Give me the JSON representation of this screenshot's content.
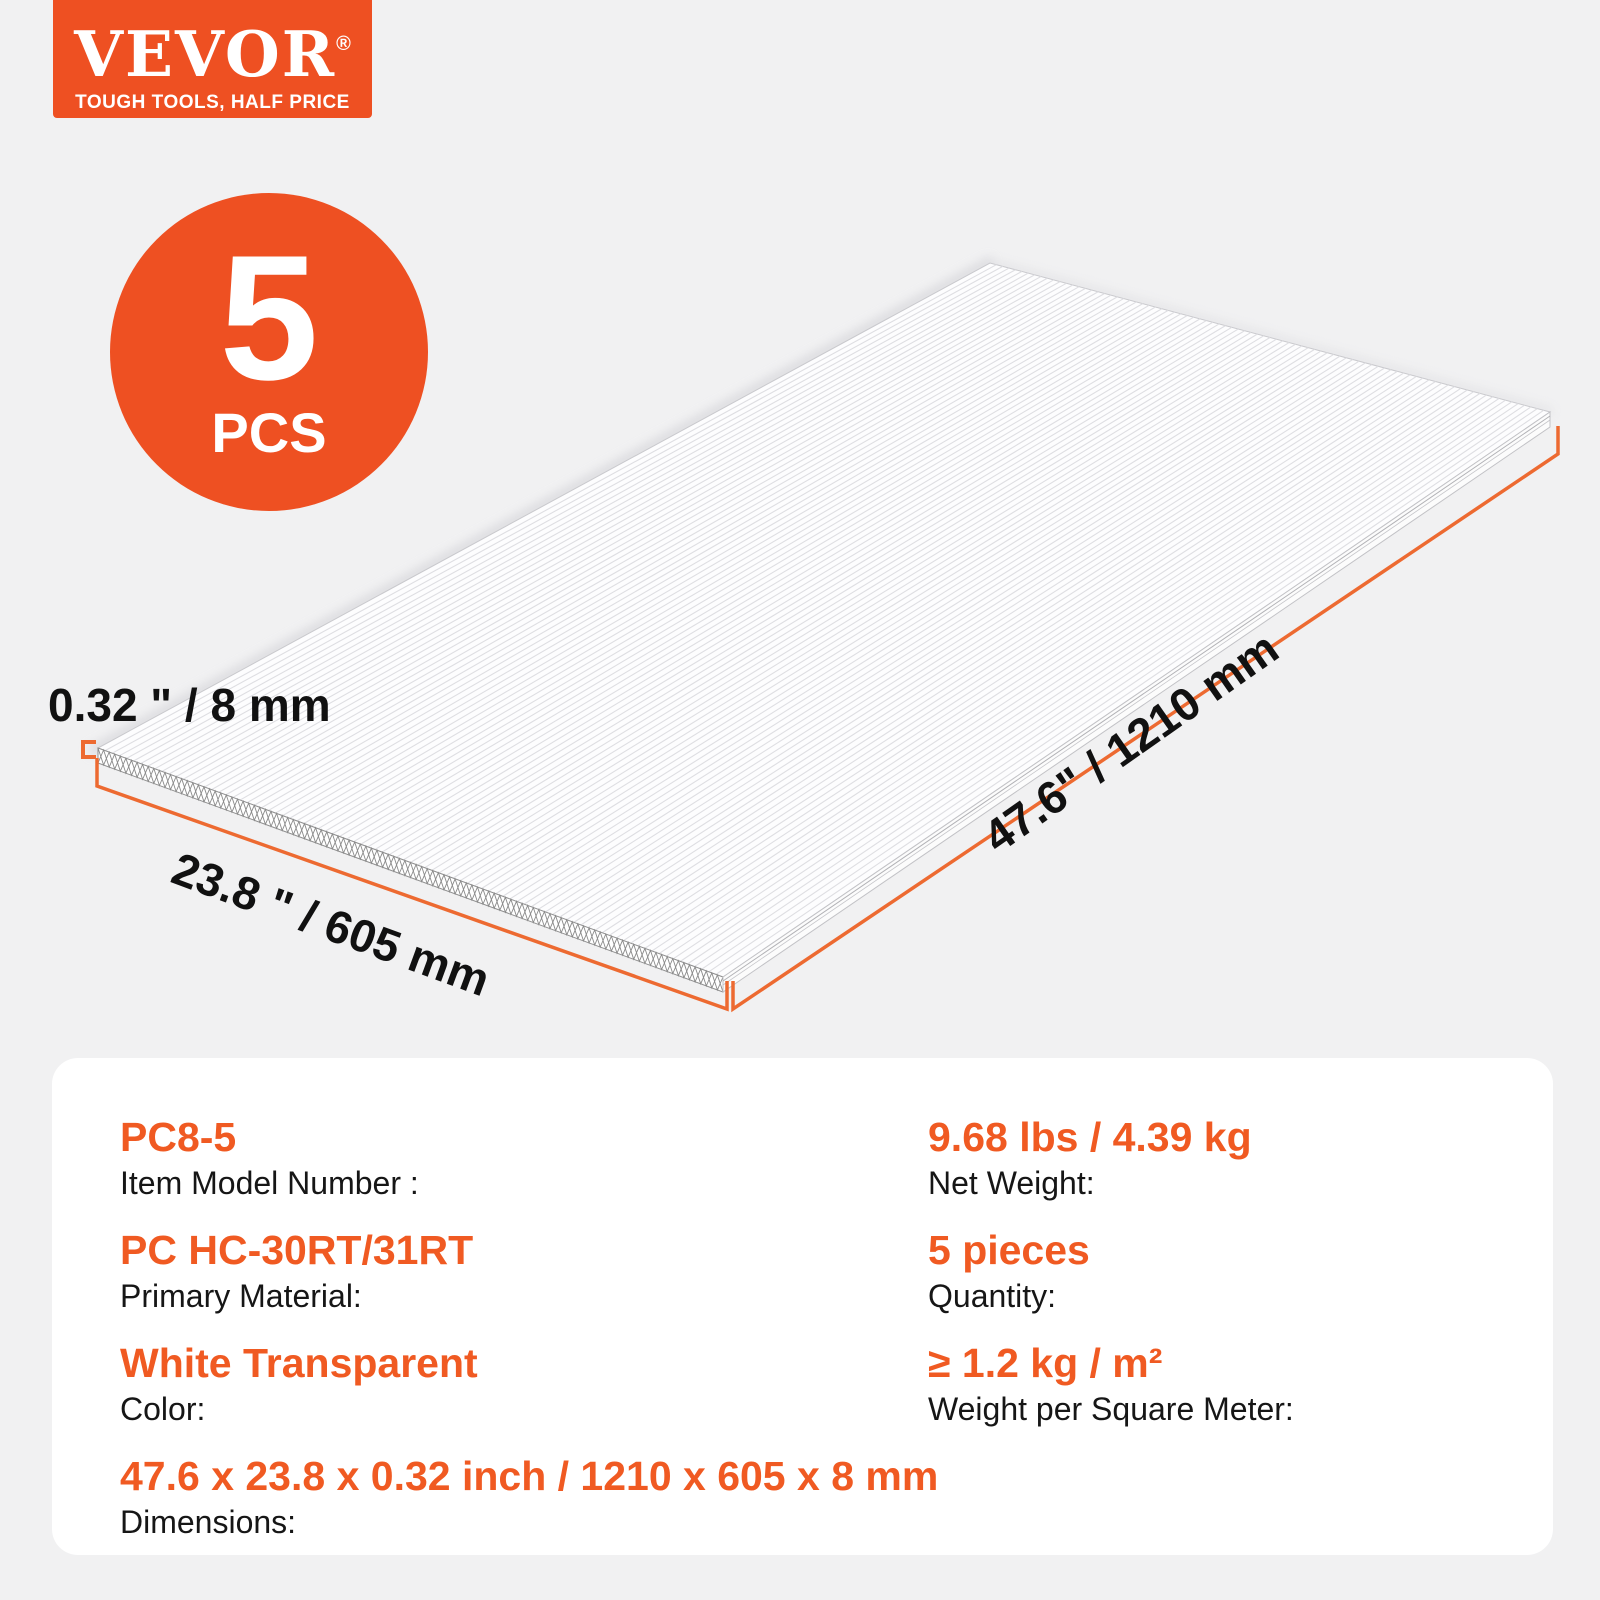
{
  "brand": {
    "name": "VEVOR",
    "registered_mark": "®",
    "tagline": "TOUGH TOOLS, HALF PRICE"
  },
  "badge": {
    "count": "5",
    "unit": "PCS"
  },
  "diagram": {
    "product": "hollow polycarbonate sheet, isometric view with honeycomb edge cross-section",
    "thickness_label": "0.32 \" / 8 mm",
    "width_label": "23.8 \" / 605 mm",
    "length_label": "47.6\" / 1210 mm"
  },
  "spec_panel": {
    "left_column": [
      {
        "value": "PC8-5",
        "label": "Item Model Number :"
      },
      {
        "value": "PC HC-30RT/31RT",
        "label": "Primary Material:"
      },
      {
        "value": "White Transparent",
        "label": "Color:"
      },
      {
        "value": "47.6 x 23.8 x 0.32 inch / 1210 x 605 x 8 mm",
        "label": "Dimensions:"
      }
    ],
    "right_column": [
      {
        "value": "9.68 lbs / 4.39 kg",
        "label": "Net Weight:"
      },
      {
        "value": "5 pieces",
        "label": "Quantity:"
      },
      {
        "value": "≥ 1.2 kg / m²",
        "label": "Weight per Square Meter:"
      }
    ]
  },
  "colors": {
    "brand_orange": "#ee5022",
    "value_orange": "#f05a22",
    "dimension_line_orange": "#ed6a31",
    "background_gray": "#f1f1f2",
    "panel_white": "#ffffff",
    "text_dark": "#111111"
  }
}
